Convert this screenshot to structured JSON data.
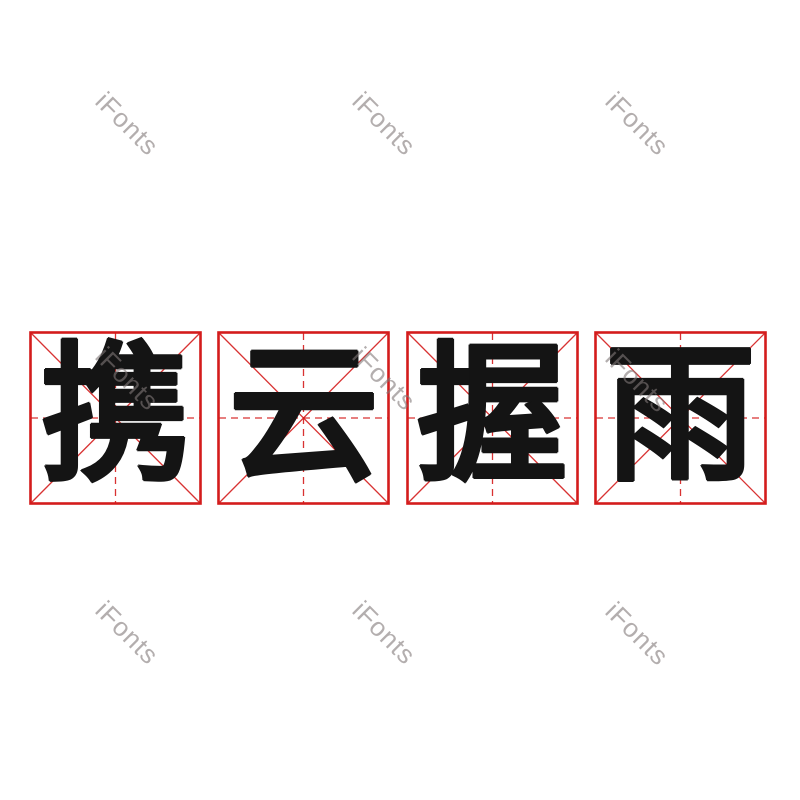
{
  "watermark": {
    "text": "iFonts"
  },
  "phrase": {
    "text": "携云握雨",
    "characters": [
      "携",
      "云",
      "握",
      "雨"
    ]
  },
  "grid": {
    "style": "mi-zi-ge practice grid",
    "box_count": 4
  },
  "colors": {
    "background": "#ffffff",
    "grid_red": "#d41c1c",
    "glyph_black": "#141414",
    "watermark_gray": "rgba(128,120,120,0.6)"
  }
}
